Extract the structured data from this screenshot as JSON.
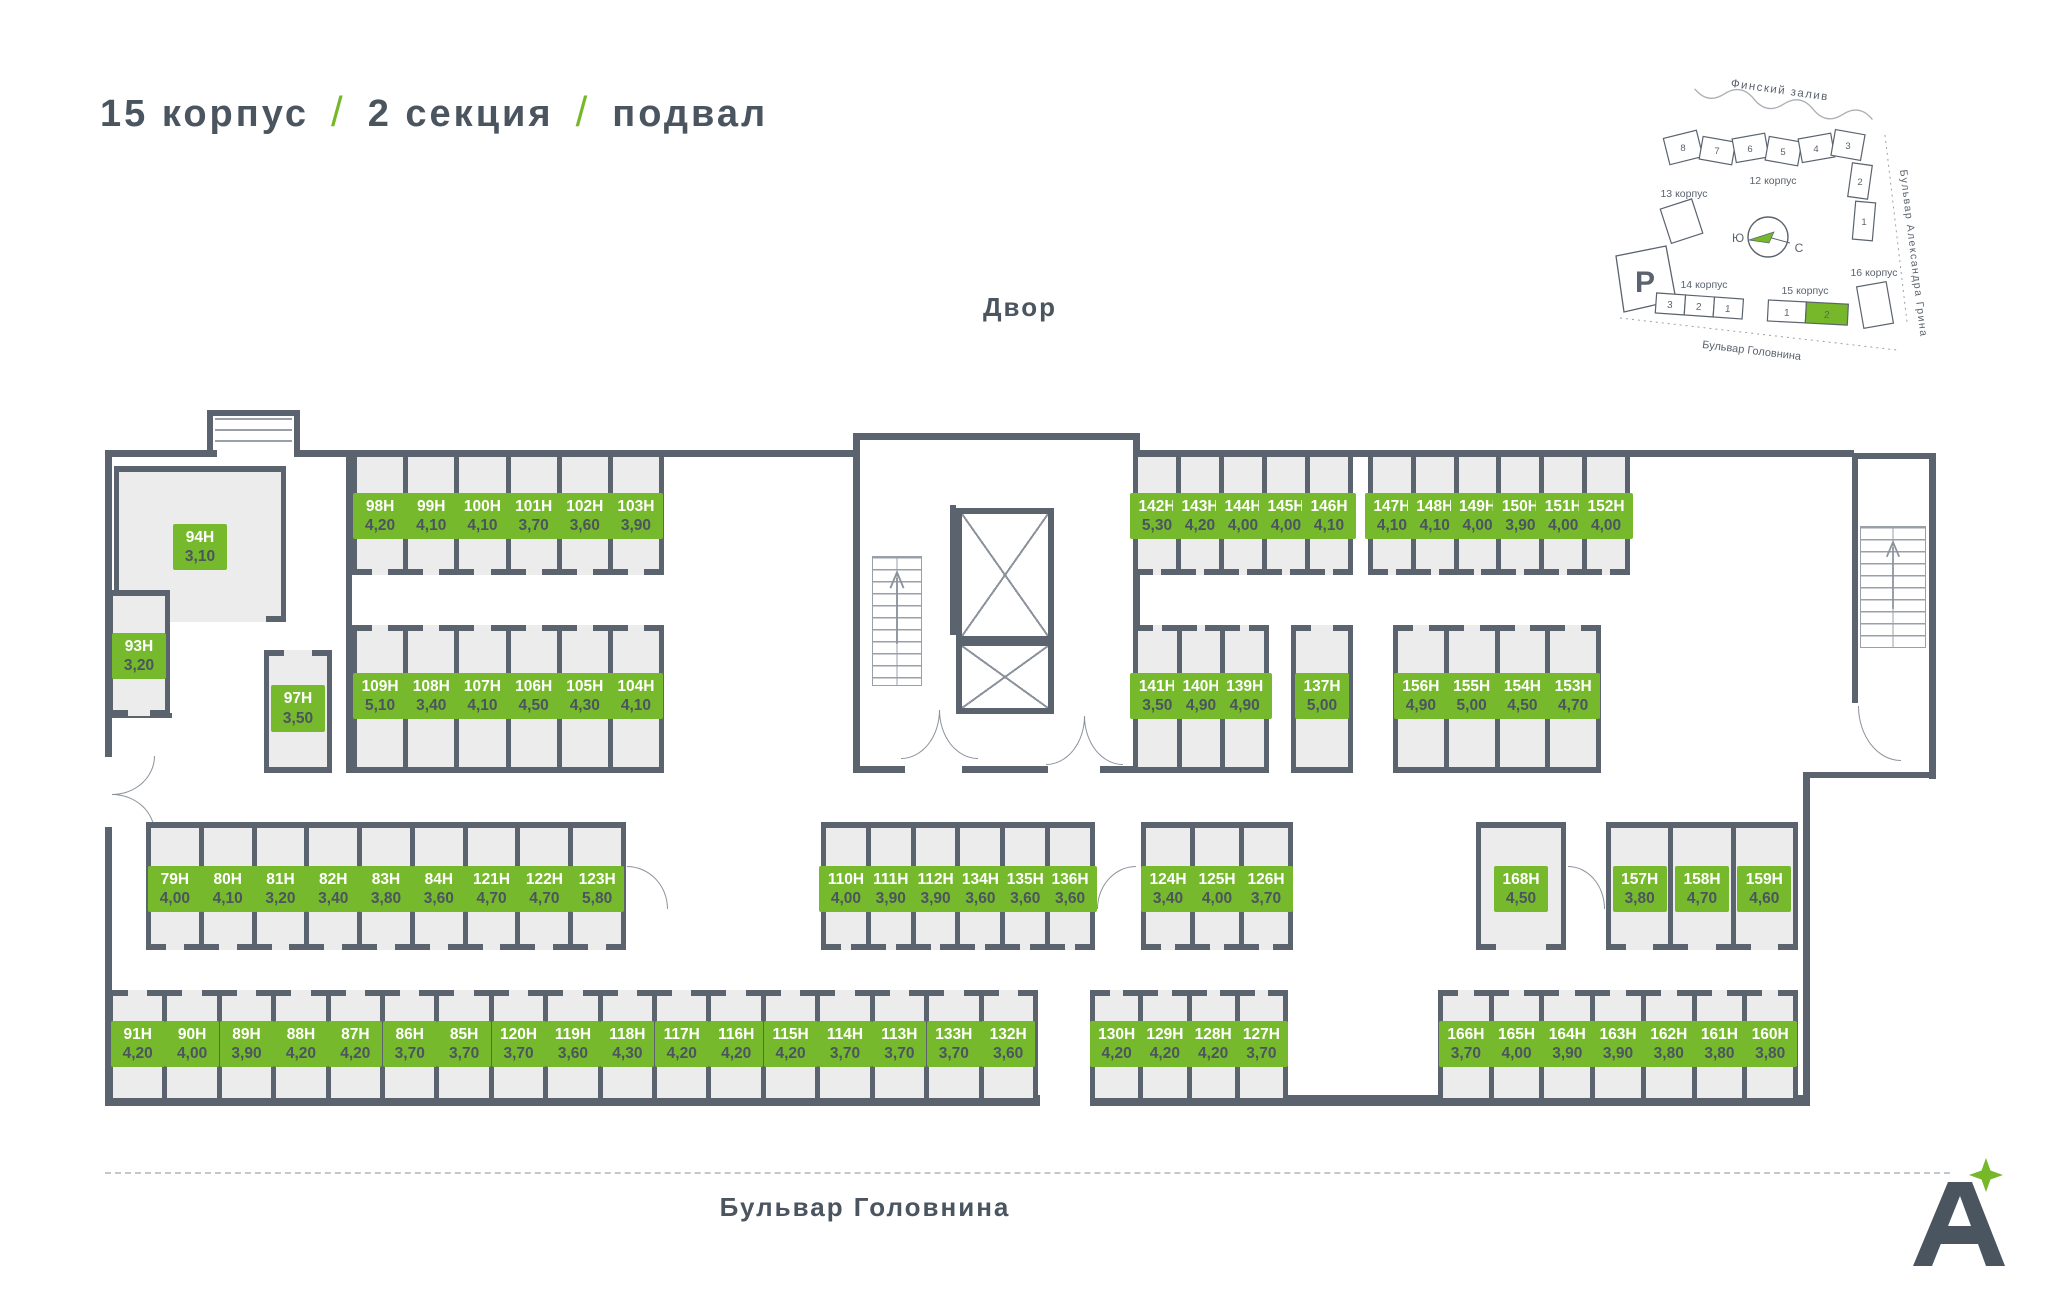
{
  "header": {
    "building": "15 корпус",
    "section": "2 секция",
    "floor": "подвал",
    "separator": "/"
  },
  "labels": {
    "courtyard": "Двор",
    "street": "Бульвар Головнина",
    "logo_letter": "А"
  },
  "colors": {
    "accent_green": "#76b82a",
    "wall": "#5b636e",
    "room_fill": "#ececec",
    "text": "#4a5560"
  },
  "minimap": {
    "gulf": "Финский залив",
    "b12": "12 корпус",
    "b13": "13 корпус",
    "b14": "14 корпус",
    "b15": "15 корпус",
    "b16": "16 корпус",
    "blvd_grina": "Бульвар Александра Грина",
    "blvd_golovnina": "Бульвар Головнина",
    "parking": "P",
    "south": "Ю",
    "north": "С",
    "b12_sections": [
      "8",
      "7",
      "6",
      "5",
      "4",
      "3",
      "2",
      "1"
    ],
    "b14_sections": [
      "3",
      "2",
      "1"
    ],
    "b15_sections": [
      "1",
      "2"
    ]
  },
  "rooms": {
    "g98": [
      {
        "id": "98Н",
        "area": "4,20"
      },
      {
        "id": "99Н",
        "area": "4,10"
      },
      {
        "id": "100Н",
        "area": "4,10"
      },
      {
        "id": "101Н",
        "area": "3,70"
      },
      {
        "id": "102Н",
        "area": "3,60"
      },
      {
        "id": "103Н",
        "area": "3,90"
      }
    ],
    "g142": [
      {
        "id": "142Н",
        "area": "5,30"
      },
      {
        "id": "143Н",
        "area": "4,20"
      },
      {
        "id": "144Н",
        "area": "4,00"
      },
      {
        "id": "145Н",
        "area": "4,00"
      },
      {
        "id": "146Н",
        "area": "4,10"
      }
    ],
    "g147": [
      {
        "id": "147Н",
        "area": "4,10"
      },
      {
        "id": "148Н",
        "area": "4,10"
      },
      {
        "id": "149Н",
        "area": "4,00"
      },
      {
        "id": "150Н",
        "area": "3,90"
      },
      {
        "id": "151Н",
        "area": "4,00"
      },
      {
        "id": "152Н",
        "area": "4,00"
      }
    ],
    "g109": [
      {
        "id": "109Н",
        "area": "5,10"
      },
      {
        "id": "108Н",
        "area": "3,40"
      },
      {
        "id": "107Н",
        "area": "4,10"
      },
      {
        "id": "106Н",
        "area": "4,50"
      },
      {
        "id": "105Н",
        "area": "4,30"
      },
      {
        "id": "104Н",
        "area": "4,10"
      }
    ],
    "g141": [
      {
        "id": "141Н",
        "area": "3,50"
      },
      {
        "id": "140Н",
        "area": "4,90"
      },
      {
        "id": "139Н",
        "area": "4,90"
      }
    ],
    "r137": [
      {
        "id": "137Н",
        "area": "5,00"
      }
    ],
    "g156": [
      {
        "id": "156Н",
        "area": "4,90"
      },
      {
        "id": "155Н",
        "area": "5,00"
      },
      {
        "id": "154Н",
        "area": "4,50"
      },
      {
        "id": "153Н",
        "area": "4,70"
      }
    ],
    "r94": [
      {
        "id": "94Н",
        "area": "3,10"
      }
    ],
    "r93": [
      {
        "id": "93Н",
        "area": "3,20"
      }
    ],
    "r97": [
      {
        "id": "97Н",
        "area": "3,50"
      }
    ],
    "g79": [
      {
        "id": "79Н",
        "area": "4,00"
      },
      {
        "id": "80Н",
        "area": "4,10"
      },
      {
        "id": "81Н",
        "area": "3,20"
      },
      {
        "id": "82Н",
        "area": "3,40"
      },
      {
        "id": "83Н",
        "area": "3,80"
      },
      {
        "id": "84Н",
        "area": "3,60"
      },
      {
        "id": "121Н",
        "area": "4,70"
      },
      {
        "id": "122Н",
        "area": "4,70"
      },
      {
        "id": "123Н",
        "area": "5,80"
      }
    ],
    "g110": [
      {
        "id": "110Н",
        "area": "4,00"
      },
      {
        "id": "111Н",
        "area": "3,90"
      },
      {
        "id": "112Н",
        "area": "3,90"
      },
      {
        "id": "134Н",
        "area": "3,60"
      },
      {
        "id": "135Н",
        "area": "3,60"
      },
      {
        "id": "136Н",
        "area": "3,60"
      }
    ],
    "g124": [
      {
        "id": "124Н",
        "area": "3,40"
      },
      {
        "id": "125Н",
        "area": "4,00"
      },
      {
        "id": "126Н",
        "area": "3,70"
      }
    ],
    "r168": [
      {
        "id": "168Н",
        "area": "4,50"
      }
    ],
    "g157": [
      {
        "id": "157Н",
        "area": "3,80"
      },
      {
        "id": "158Н",
        "area": "4,70"
      },
      {
        "id": "159Н",
        "area": "4,60"
      }
    ],
    "g91": [
      {
        "id": "91Н",
        "area": "4,20"
      },
      {
        "id": "90Н",
        "area": "4,00"
      },
      {
        "id": "89Н",
        "area": "3,90"
      },
      {
        "id": "88Н",
        "area": "4,20"
      },
      {
        "id": "87Н",
        "area": "4,20"
      },
      {
        "id": "86Н",
        "area": "3,70"
      },
      {
        "id": "85Н",
        "area": "3,70"
      },
      {
        "id": "120Н",
        "area": "3,70"
      },
      {
        "id": "119Н",
        "area": "3,60"
      },
      {
        "id": "118Н",
        "area": "4,30"
      },
      {
        "id": "117Н",
        "area": "4,20"
      },
      {
        "id": "116Н",
        "area": "4,20"
      },
      {
        "id": "115Н",
        "area": "4,20"
      },
      {
        "id": "114Н",
        "area": "3,70"
      },
      {
        "id": "113Н",
        "area": "3,70"
      },
      {
        "id": "133Н",
        "area": "3,70"
      },
      {
        "id": "132Н",
        "area": "3,60"
      }
    ],
    "g130": [
      {
        "id": "130Н",
        "area": "4,20"
      },
      {
        "id": "129Н",
        "area": "4,20"
      },
      {
        "id": "128Н",
        "area": "4,20"
      },
      {
        "id": "127Н",
        "area": "3,70"
      }
    ],
    "g166": [
      {
        "id": "166Н",
        "area": "3,70"
      },
      {
        "id": "165Н",
        "area": "4,00"
      },
      {
        "id": "164Н",
        "area": "3,90"
      },
      {
        "id": "163Н",
        "area": "3,90"
      },
      {
        "id": "162Н",
        "area": "3,80"
      },
      {
        "id": "161Н",
        "area": "3,80"
      },
      {
        "id": "160Н",
        "area": "3,80"
      }
    ]
  }
}
